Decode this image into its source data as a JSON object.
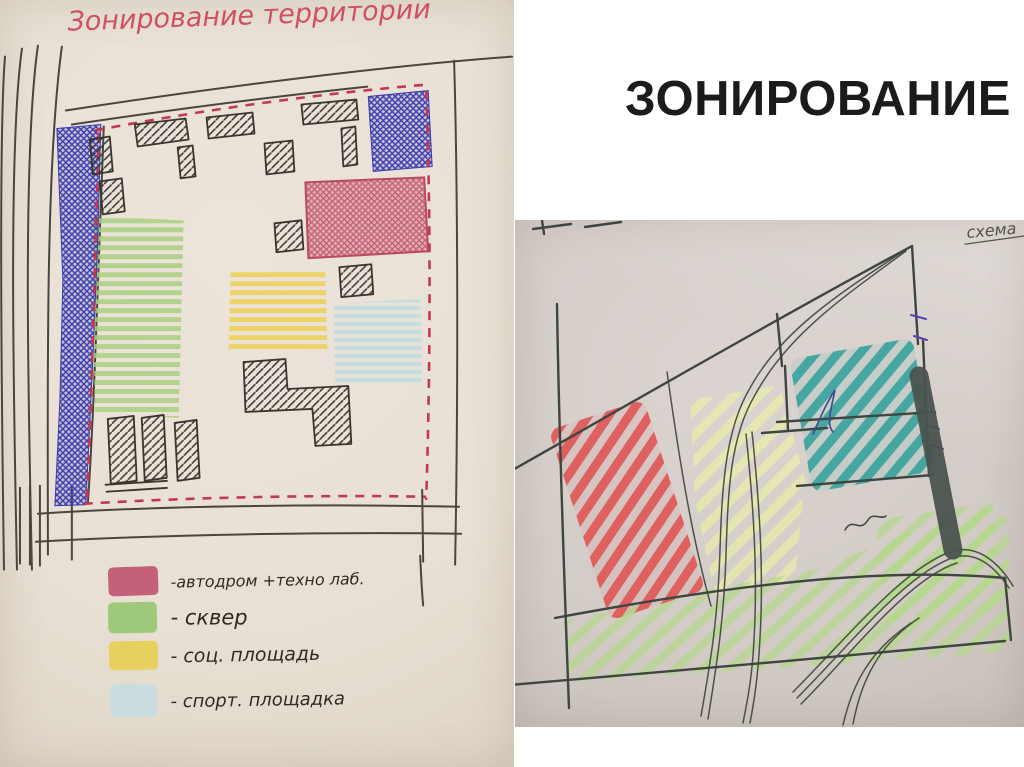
{
  "slide": {
    "title": "ЗОНИРОВАНИЕ",
    "title_color": "#1b1b1b",
    "background_color": "#ffffff"
  },
  "left_sketch": {
    "title": "Зонирование территории",
    "title_color": "#cf4f66",
    "legend": [
      {
        "label": "-автодром +техно лаб.",
        "color": "#c4607a"
      },
      {
        "label": "- сквер",
        "color": "#9ec97c"
      },
      {
        "label": "- соц. площадь",
        "color": "#e8d05e"
      },
      {
        "label": "- спорт. площадка",
        "color": "#c9dcdf"
      }
    ],
    "zone_colors": {
      "pen_crosshatch_blue": "#3a3cae",
      "autodrome_red": "#c25c74",
      "garden_green": "#a9d07f",
      "social_square_yellow": "#ecd35c",
      "sports_ground_cyan": "#c2dde2",
      "boundary_dash_red": "#c23a51",
      "ink": "#44423c"
    }
  },
  "right_sketch": {
    "annotation": "схема",
    "zone_colors": {
      "red": "#e05555",
      "teal": "#37a29c",
      "green": "#b3d888",
      "yellow": "#eff3a2",
      "dark_bar": "#4a534f",
      "ink": "#3f4540"
    }
  }
}
